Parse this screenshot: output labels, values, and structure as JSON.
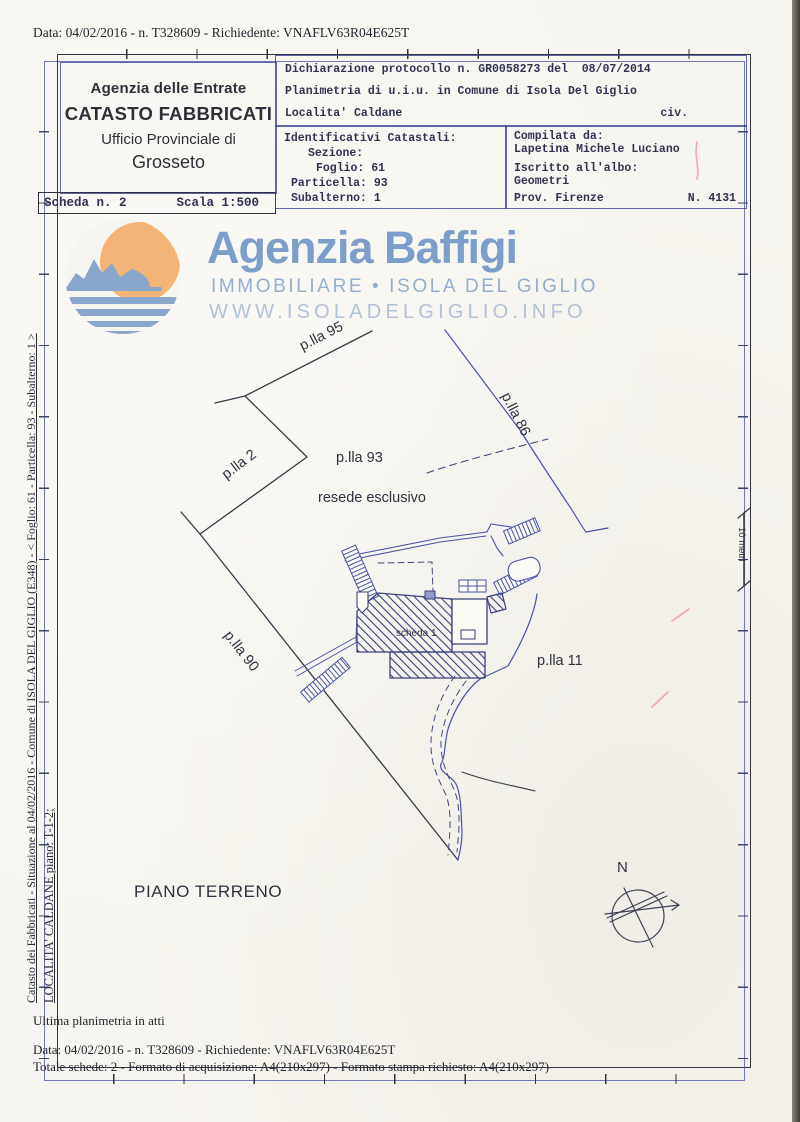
{
  "page": {
    "title_line": "Data: 04/02/2016 - n. T328609 - Richiedente: VNAFLV63R04E625T"
  },
  "header": {
    "office": {
      "agency": "Agenzia delle Entrate",
      "registry": "CATASTO FABBRICATI",
      "office_line": "Ufficio Provinciale di",
      "city": "Grosseto"
    },
    "sheet": {
      "sheet_no": "Scheda n. 2",
      "scale": "Scala 1:500"
    },
    "declaration": {
      "protocol": "Dichiarazione protocollo n. GR0058273 del  08/07/2014",
      "planimetria": "Planimetria di u.i.u. in Comune di Isola Del Giglio",
      "localita": "Localita' Caldane",
      "civ": "civ."
    },
    "identifiers": {
      "title": "Identificativi Catastali:",
      "sezione": "Sezione:",
      "foglio": "Foglio: 61",
      "particella": "Particella: 93",
      "subalterno": "Subalterno: 1"
    },
    "compiler": {
      "label": "Compilata da:",
      "name": "Lapetina Michele Luciano",
      "albo_label": "Iscritto all'albo:",
      "albo": "Geometri",
      "prov": "Prov. Firenze",
      "reg_no": "N. 4131"
    }
  },
  "watermark": {
    "brand": "Agenzia Baffigi",
    "tagline": "IMMOBILIARE  •  ISOLA DEL GIGLIO",
    "website": "WWW.ISOLADELGIGLIO.INFO",
    "brand_color": "#7d9ec9",
    "tagline_color": "#94afd0",
    "website_color": "#b2c3d9",
    "sun_color": "#f4b478",
    "sea_color": "#8ba6cb"
  },
  "plan": {
    "labels": {
      "parcel_95": "p.lla 95",
      "parcel_86": "p.lla 86",
      "parcel_2": "p.lla 2",
      "parcel_90": "p.lla 90",
      "parcel_93": "p.lla 93",
      "resede": "resede esclusivo",
      "parcel_11": "p.lla 11",
      "scheda_1": "scheda 1",
      "floor": "PIANO TERRENO",
      "north": "N",
      "scale_bar": "10 metri"
    },
    "ink_blue": "#4754a5",
    "ink_dark": "#383a49"
  },
  "sidebar": {
    "line1": "Catasto dei Fabbricati - Situazione al 04/02/2016 - Comune di ISOLA DEL GIGLIO (E348) - < Foglio: 61 - Particella: 93 - Subalterno: 1 >",
    "line2": "LOCALITA' CALDANE piano: T-1-2;"
  },
  "footer": {
    "note": "Ultima planimetria in atti",
    "data_line": "Data: 04/02/2016 - n. T328609 - Richiedente: VNAFLV63R04E625T",
    "totals_line": "Totale schede: 2 - Formato di acquisizione: A4(210x297)  - Formato stampa richiesto: A4(210x297)"
  }
}
